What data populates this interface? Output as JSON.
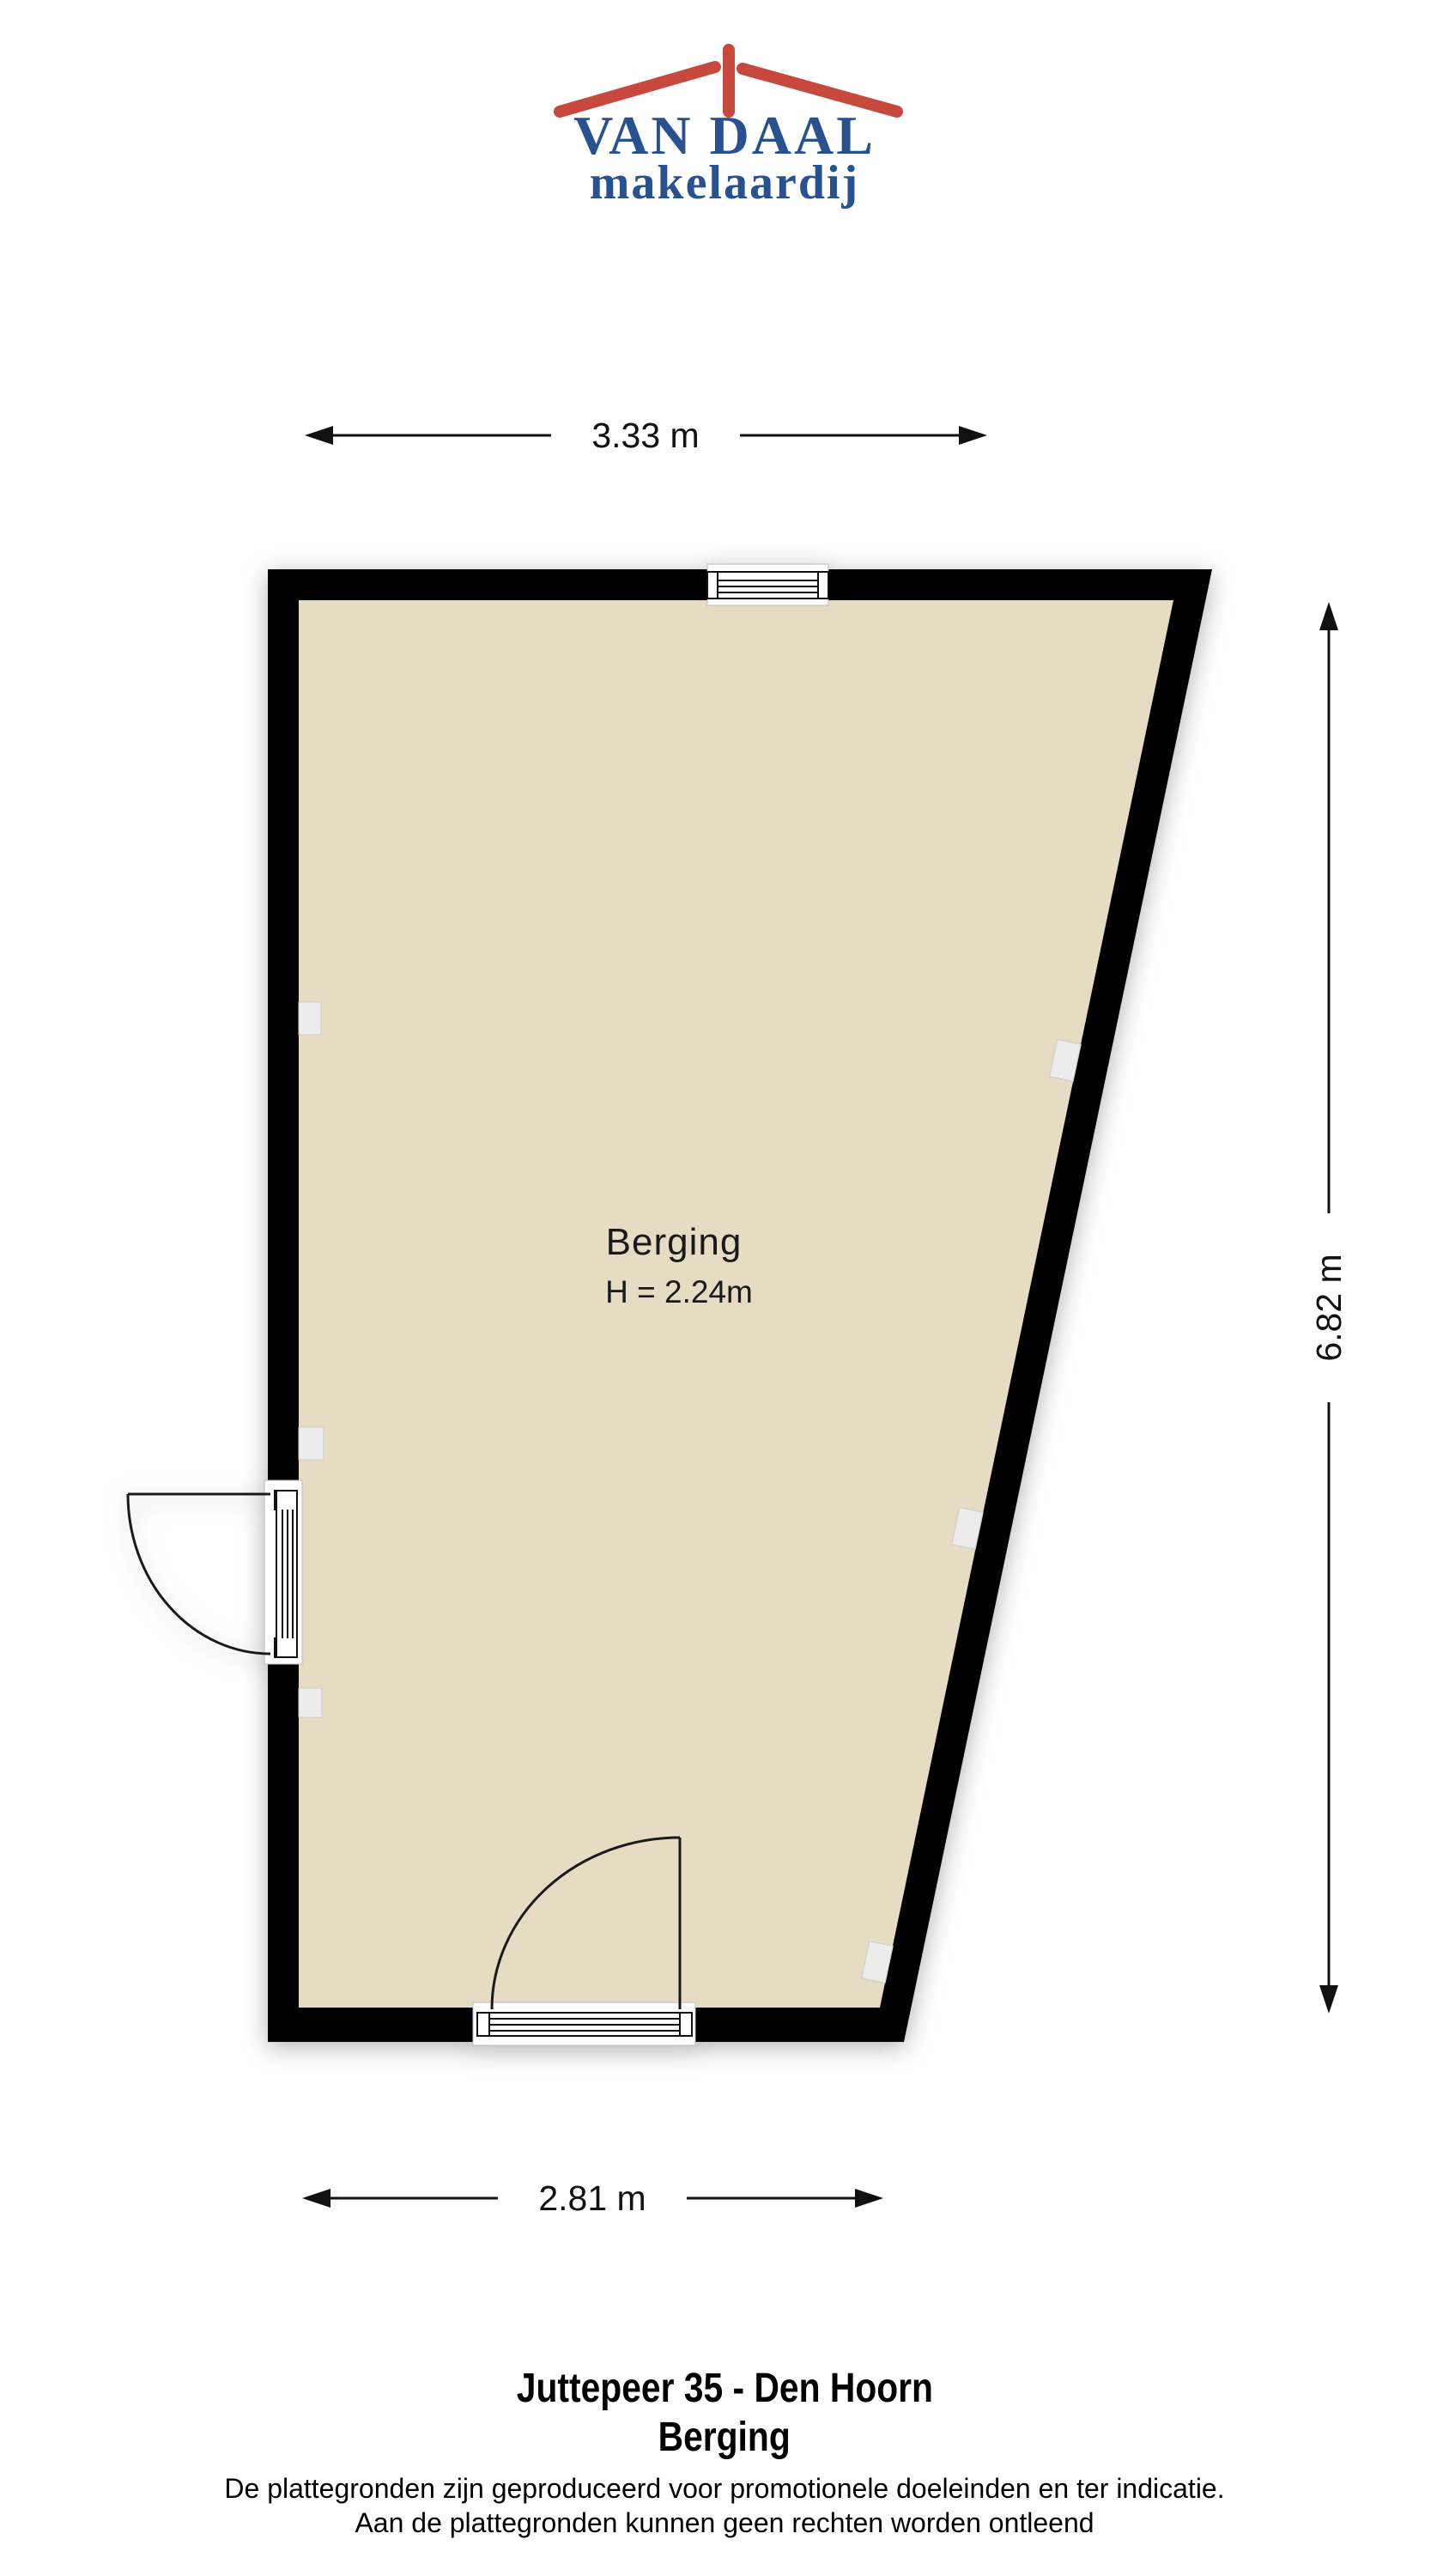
{
  "logo": {
    "name": "VAN DAAL",
    "tagline": "makelaardij",
    "roof_icon": "roof-icon"
  },
  "dimensions": {
    "top": "3.33 m",
    "right": "6.82 m",
    "bottom": "2.81 m"
  },
  "room": {
    "name": "Berging",
    "ceiling_height": "H = 2.24m"
  },
  "footer": {
    "address": "Juttepeer 35 - Den Hoorn",
    "room": "Berging",
    "disclaimer_line1": "De plattegronden zijn geproduceerd voor promotionele doeleinden en ter indicatie.",
    "disclaimer_line2": "Aan de plattegronden kunnen geen rechten worden ontleend"
  },
  "colors": {
    "floor": "#e6dcc3",
    "wall": "#000000",
    "line": "#1a1a1a",
    "fixture": "#ececec",
    "logo_red": "#c7493e",
    "logo_blue": "#27518f"
  }
}
